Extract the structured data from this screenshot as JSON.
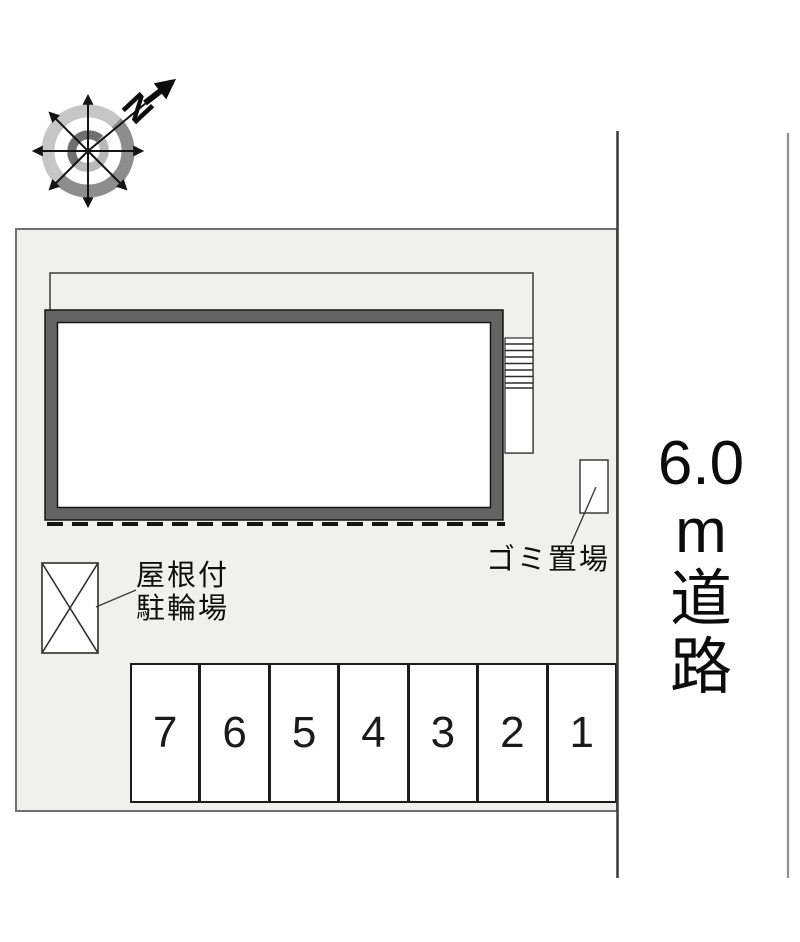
{
  "compass": {
    "north_label": "N"
  },
  "road": {
    "width_text": "6.0m道路",
    "label_lines": [
      "6.0",
      "m",
      "道",
      "路"
    ]
  },
  "annotations": {
    "garbage": {
      "label": "ゴミ置場"
    },
    "bicycle": {
      "label_line1": "屋根付",
      "label_line2": "駐輪場"
    }
  },
  "parking": {
    "numbers": [
      "7",
      "6",
      "5",
      "4",
      "3",
      "2",
      "1"
    ]
  },
  "colors": {
    "site_fill": "#f0f0ee",
    "site_border": "#717171",
    "building_band": "#646464",
    "line_dark": "#1c1c1c",
    "road_edge_dark": "#3a3a3a",
    "road_edge_light": "#8f8f8f",
    "compass_ring_light": "#c6c6c6",
    "compass_ring_dark": "#8d8d8d"
  }
}
